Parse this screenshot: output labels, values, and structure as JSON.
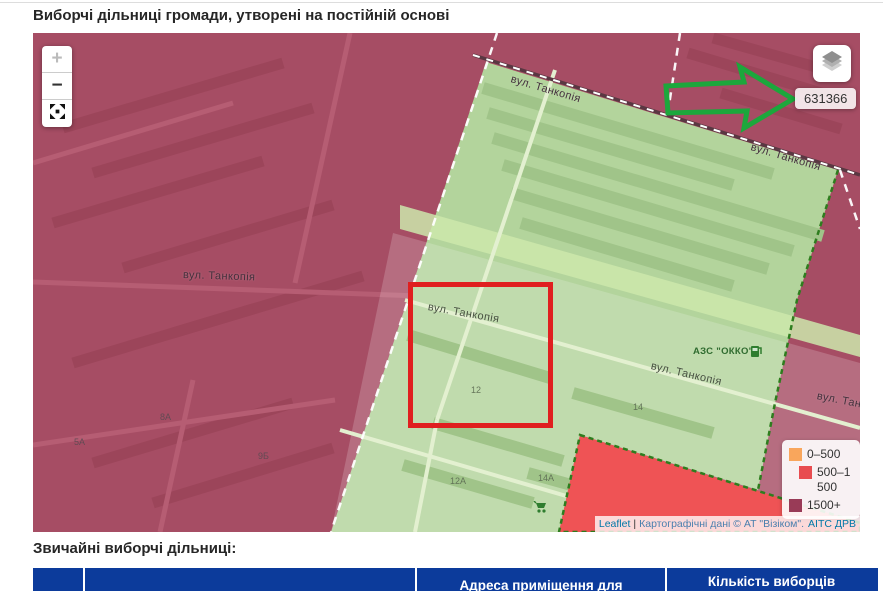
{
  "header": {
    "title": "Виборчі дільниці громади, утворені на постійній основі"
  },
  "map": {
    "controls": {
      "zoom_in": "+",
      "zoom_out": "−"
    },
    "station_badge": "631366",
    "street_name": "вул. Танкопія",
    "gas_station_label": "АЗС \"ОККО\"",
    "building_numbers": [
      "12",
      "14",
      "12А",
      "14А",
      "8А",
      "5А",
      "9Б"
    ],
    "legend": {
      "items": [
        {
          "label": "0–500",
          "color": "#f9a65c"
        },
        {
          "label": "500–1500",
          "color": "#e84c50"
        },
        {
          "label": "1500+",
          "color": "#993b57"
        }
      ]
    },
    "attribution": {
      "leaflet_link": "Leaflet",
      "separator": "|",
      "source_link": "Картографічні дані © АТ \"Візіком\".",
      "registry_link": "АІТС ДРВ"
    }
  },
  "section": {
    "title": "Звичайні виборчі дільниці:"
  },
  "table": {
    "header_address": "Адреса приміщення для голосування",
    "header_voters": "Кількість виборців"
  },
  "colors": {
    "district_low": "#f9a65c",
    "district_mid": "#e84c50",
    "district_high": "#993b57",
    "selected_district_green": "#b3d49c",
    "annotation_red": "#e01f1f",
    "annotation_green": "#1ca73c",
    "table_header_blue": "#0c3b9b"
  }
}
